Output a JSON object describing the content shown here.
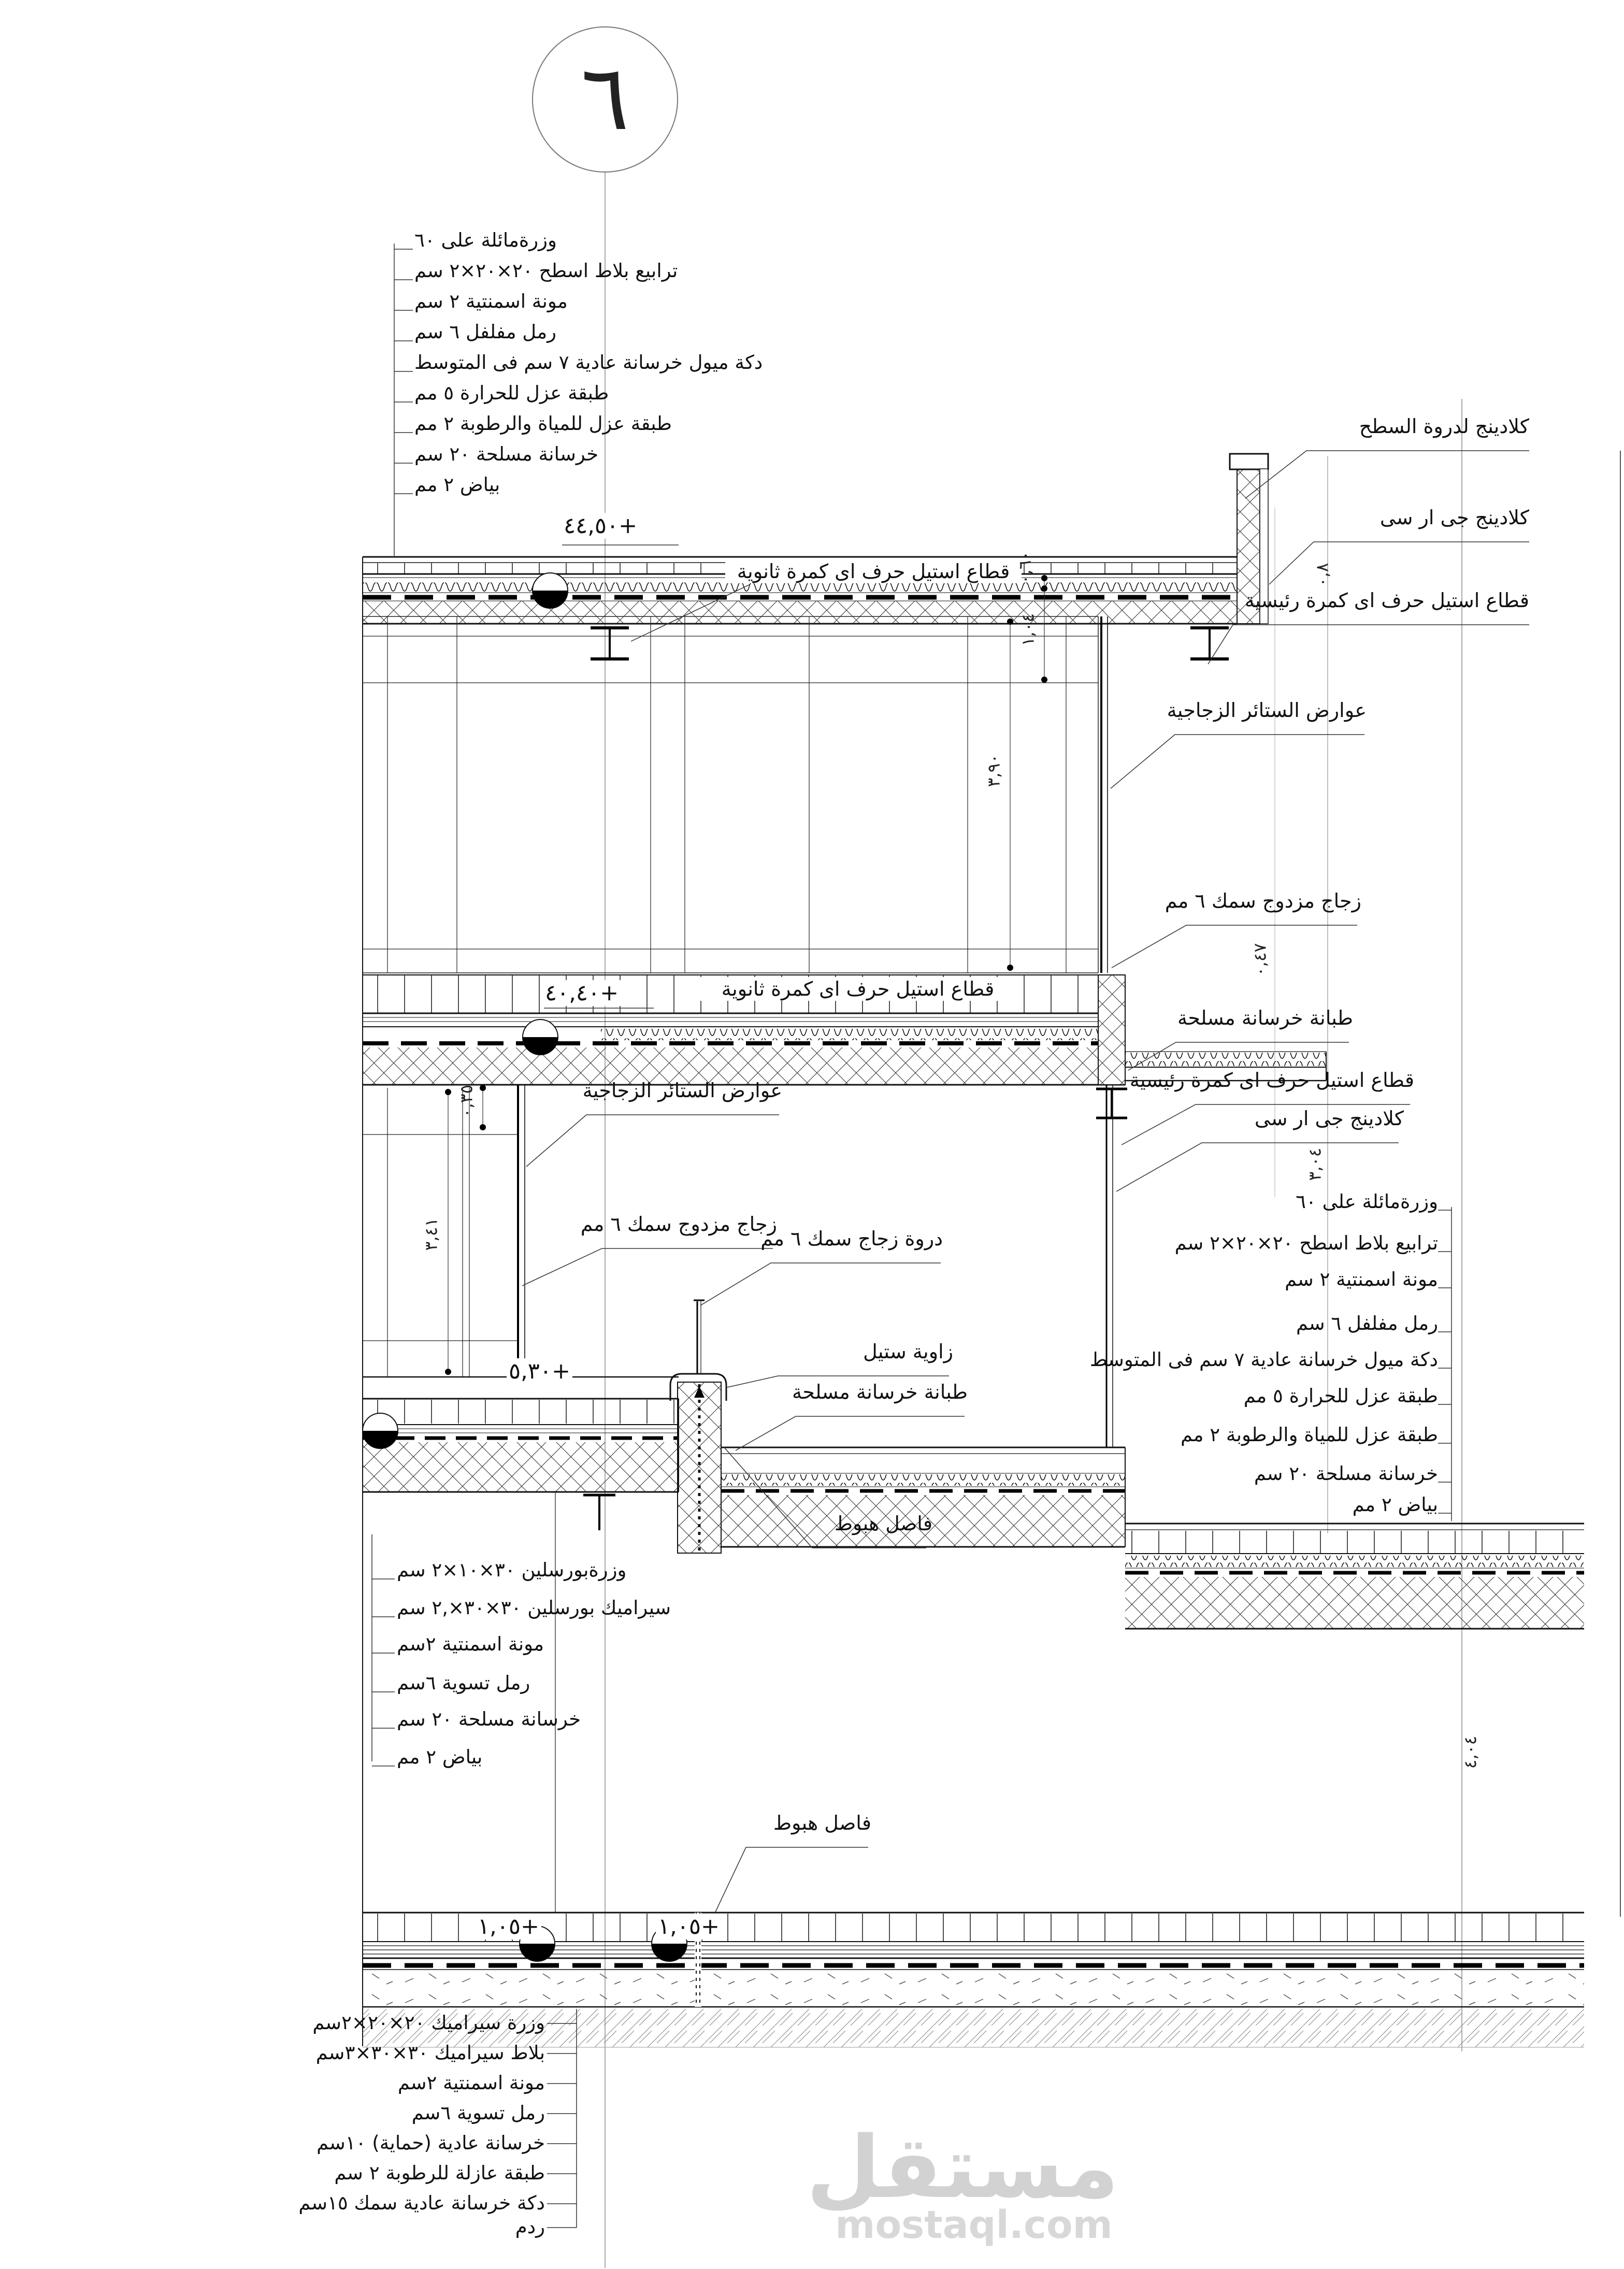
{
  "drawing": {
    "detail_number": "٦",
    "watermark_logo": "مستقل",
    "watermark_domain": "mostaql.com"
  },
  "stacks": {
    "roof_left": [
      "وزرةمائلة على ٦٠",
      "ترابيع بلاط اسطح ٢٠×٢٠×٢ سم",
      "مونة اسمنتية ٢ سم",
      "رمل مفلفل ٦ سم",
      "دكة ميول خرسانة عادية ٧ سم فى المتوسط",
      "طبقة عزل للحرارة ٥ مم",
      "طبقة عزل للمياة والرطوبة ٢ مم",
      "خرسانة مسلحة ٢٠ سم",
      "بياض ٢ مم"
    ],
    "terrace_right": [
      "وزرةمائلة على ٦٠",
      "ترابيع بلاط اسطح ٢٠×٢٠×٢ سم",
      "مونة اسمنتية ٢ سم",
      "رمل مفلفل ٦ سم",
      "دكة ميول خرسانة عادية ٧ سم فى المتوسط",
      "طبقة عزل للحرارة ٥ مم",
      "طبقة عزل للمياة والرطوبة ٢ مم",
      "خرسانة مسلحة ٢٠ سم",
      "بياض ٢ مم"
    ],
    "porcelain": [
      "وزرةبورسلين ٣٠×١٠×٢ سم",
      "سيراميك بورسلين ٣٠×٣٠×,٢ سم",
      "مونة اسمنتية ٢سم",
      "رمل تسوية ٦سم",
      "خرسانة مسلحة ٢٠ سم",
      "بياض ٢ مم"
    ],
    "ground": [
      "وزرة سيراميك ٢٠×٢٠×٢سم",
      "بلاط سيراميك ٣٠×٣٠×٣سم",
      "مونة اسمنتية ٢سم",
      "رمل تسوية ٦سم",
      "خرسانة عادية (حماية) ١٠سم",
      "طبقة عازلة للرطوبة ٢ سم",
      "دكة خرسانة عادية سمك ١٥سم",
      "ردم"
    ]
  },
  "levels": {
    "roof": "٤٤,٥٠+",
    "mid": "٤٠,٤٠+",
    "lower": "٥,٣٠+",
    "ground_a": "١,٠٥+",
    "ground_b": "١,٠٥+"
  },
  "callouts": {
    "cladding_parapet": "كلادينج لدروة السطح",
    "cladding_grc_roof": "كلادينج جى ار سى",
    "steel_main_roof": "قطاع استيل حرف اى كمرة رئيسية",
    "mullions_roof": "عوارض الستائر الزجاجية",
    "glass_roof": "زجاج مزدوج سمك ٦ مم",
    "secondary_beam_roof": "قطاع استيل حرف اى كمرة ثانوية",
    "screed_mid": "طبانة خرسانة مسلحة",
    "steel_main_mid": "قطاع استيل حرف اى كمرة رئيسية",
    "cladding_grc_mid": "كلادينج جى ار سى",
    "secondary_beam_mid": "قطاع استيل حرف اى كمرة ثانوية",
    "mullions_mid": "عوارض الستائر الزجاجية",
    "glass_lower": "زجاج مزدوج سمك ٦ مم",
    "glass_parapet": "دروة زجاج سمك ٦ مم",
    "steel_angle": "زاوية ستيل",
    "screed_lower": "طبانة خرسانة مسلحة",
    "joint_terrace": "فاصل هبوط",
    "joint_ground": "فاصل هبوط"
  },
  "dims": {
    "h390": "٣,٩٠",
    "h104": "١,٠٤",
    "h060": "٠,٦٠",
    "p08": "٠,٨",
    "b047": "٠,٤٧",
    "s304": "٣,٠٤",
    "t035": "٠,٣٥",
    "h341": "٣,٤١",
    "g404": "٤,٠٤"
  }
}
